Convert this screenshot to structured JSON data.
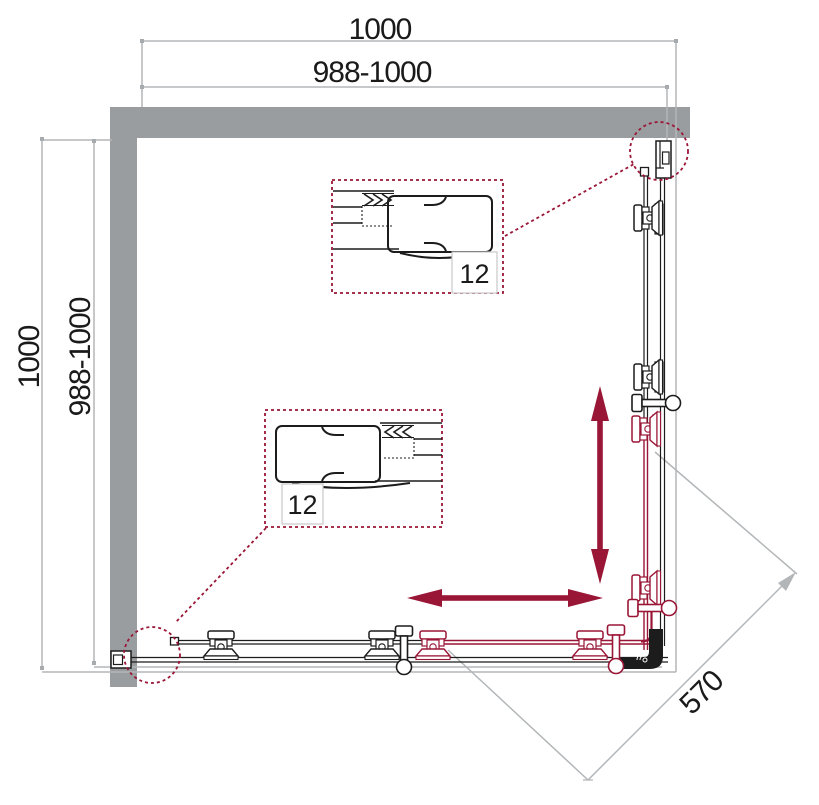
{
  "drawing": {
    "type": "shower-enclosure-plan",
    "dimensions": {
      "top_width": "1000",
      "top_width_range": "988-1000",
      "side_depth": "1000",
      "side_depth_range": "988-1000",
      "diagonal_opening": "570"
    },
    "detail_callouts": {
      "top_profile_label": "12",
      "bottom_profile_label": "12"
    },
    "colors": {
      "wall_gray": "#9a9da0",
      "dimension_gray": "#b3b6b8",
      "line_black": "#1c1c1c",
      "accent_crimson": "#9a1636"
    },
    "icons": {
      "vertical_slide_arrow": "updown-double-arrow",
      "horizontal_slide_arrow": "leftright-double-arrow"
    }
  }
}
